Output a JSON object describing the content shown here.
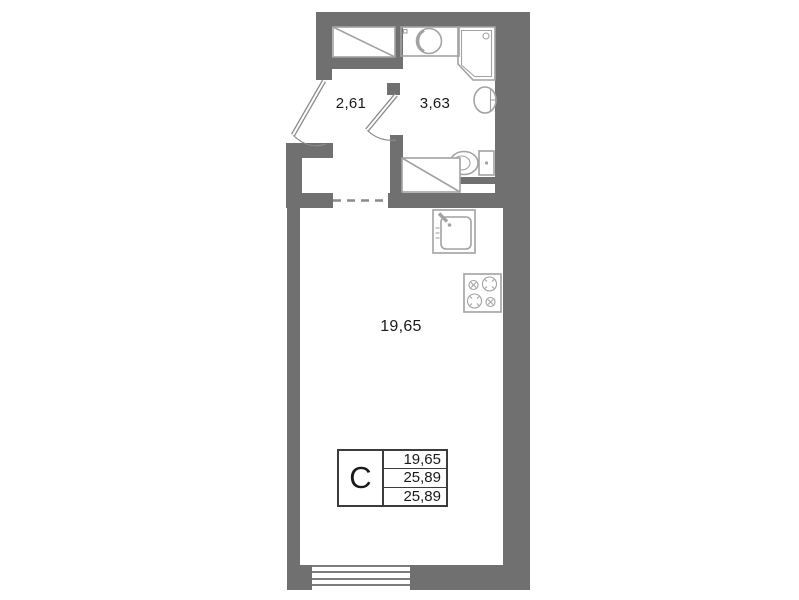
{
  "rooms": [
    {
      "name": "hallway",
      "area": "2,61"
    },
    {
      "name": "bathroom",
      "area": "3,63"
    },
    {
      "name": "living-room",
      "area": "19,65"
    }
  ],
  "legend": {
    "type": "С",
    "values": [
      "19,65",
      "25,89",
      "25,89"
    ]
  },
  "fixtures": [
    "wardrobe-icon",
    "entry-door-icon",
    "bathroom-door-icon",
    "washbasin-counter-icon",
    "shower-cabin-icon",
    "wall-basin-icon",
    "toilet-icon",
    "washing-machine-icon",
    "dashed-opening-icon",
    "kitchen-sink-icon",
    "stove-icon",
    "window-icon"
  ],
  "colors": {
    "wall": "#707070",
    "fixture": "#a2a2a2",
    "door": "#8a8a8a",
    "text": "#1a1a1a",
    "table_border": "#3c3c3c",
    "window_line": "#7d7d7d"
  }
}
